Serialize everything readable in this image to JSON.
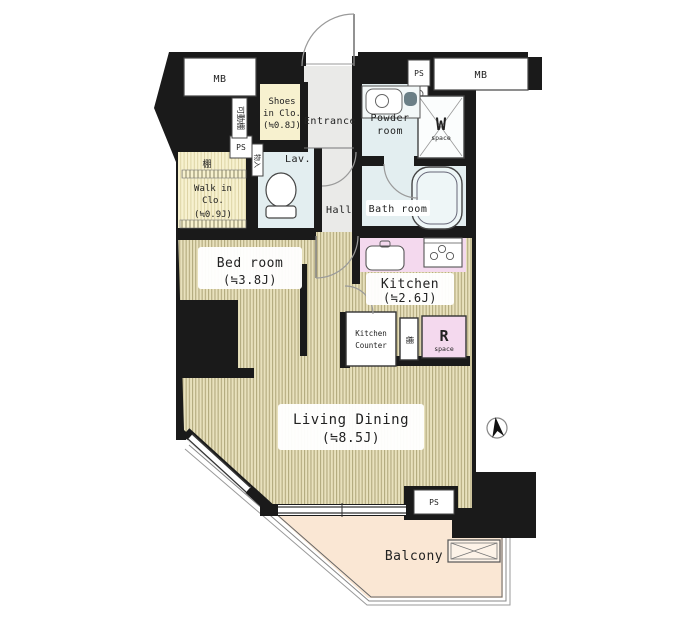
{
  "plan_title": "1K apartment floor plan",
  "rooms": {
    "bedroom": {
      "name": "Bed room",
      "size": "(≒3.8J)"
    },
    "living": {
      "name": "Living Dining",
      "size": "(≒8.5J)"
    },
    "kitchen": {
      "name": "Kitchen",
      "size": "(≒2.6J)"
    },
    "walkin": {
      "l1": "Walk in",
      "l2": "Clo.",
      "l3": "(≒0.9J)"
    },
    "shoes": {
      "l1": "Shoes",
      "l2": "in Clo.",
      "l3": "(≒0.8J)"
    },
    "entrance": "Entrance",
    "hall": "Hall",
    "lav": "Lav.",
    "powder": {
      "l1": "Powder",
      "l2": "room"
    },
    "bath": "Bath room",
    "balcony": "Balcony"
  },
  "utilities": {
    "mb_left": "MB",
    "mb_right": "MB",
    "ps_top": "PS",
    "ps_left": "PS",
    "ps_bottom": "PS",
    "w_space": {
      "big": "W",
      "small": "space"
    },
    "r_space": {
      "big": "R",
      "small": "space"
    },
    "kitchen_counter": {
      "l1": "Kitchen",
      "l2": "Counter"
    },
    "shelf_wic": "棚",
    "shelf_kitchen": "棚",
    "movable_shelf": "可動棚",
    "lav_cabinet": "物入"
  },
  "icons": {
    "north_arrow": "compass-north-arrow",
    "w_space_cross": "washer-space-cross",
    "balcony_hatch": "evacuation-hatch"
  },
  "colors": {
    "wall": "#1a1a1a",
    "flooring": "#e8e1bd",
    "flooring_stripe": "#b2a97e",
    "closet": "#f7f1cf",
    "wet_room": "#e3eef0",
    "hallway": "#eaeae8",
    "counter_pink": "#f4d9ee",
    "balcony": "#fae7d4"
  }
}
